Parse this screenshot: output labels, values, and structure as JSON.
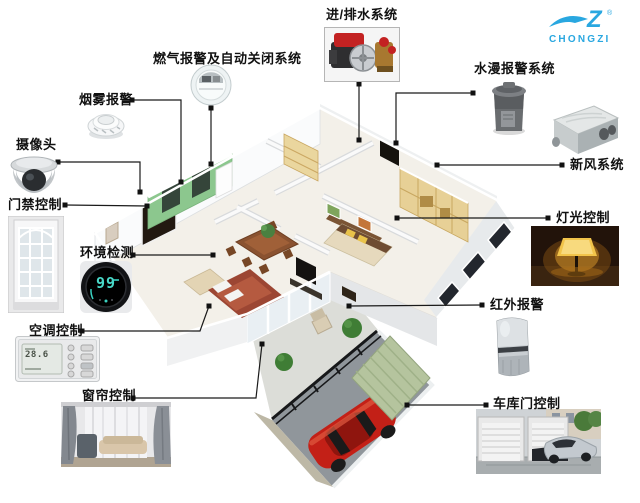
{
  "logo": {
    "mark": "Z",
    "registered": "®",
    "brand": "CHONGZI"
  },
  "systems": [
    {
      "id": "water-supply-drain",
      "label": "进/排水系统"
    },
    {
      "id": "gas-alarm-auto-shutoff",
      "label": "燃气报警及自动关闭系统"
    },
    {
      "id": "flood-alarm",
      "label": "水漫报警系统"
    },
    {
      "id": "smoke-alarm",
      "label": "烟雾报警"
    },
    {
      "id": "camera",
      "label": "摄像头"
    },
    {
      "id": "fresh-air-system",
      "label": "新风系统"
    },
    {
      "id": "door-access-control",
      "label": "门禁控制"
    },
    {
      "id": "lighting-control",
      "label": "灯光控制"
    },
    {
      "id": "environment-monitor",
      "label": "环境检测"
    },
    {
      "id": "infrared-alarm",
      "label": "红外报警"
    },
    {
      "id": "ac-control",
      "label": "空调控制"
    },
    {
      "id": "curtain-control",
      "label": "窗帘控制"
    },
    {
      "id": "garage-door-control",
      "label": "车库门控制"
    }
  ],
  "device_displays": {
    "environment_value": "99",
    "ac_value": "28.6"
  },
  "colors": {
    "connector_line": "#1a1a1a",
    "logo_blue": "#29a7e0",
    "car_red": "#c32017",
    "kitchen_green": "#8cc78e",
    "garage_roof_green": "#b5c49e"
  }
}
